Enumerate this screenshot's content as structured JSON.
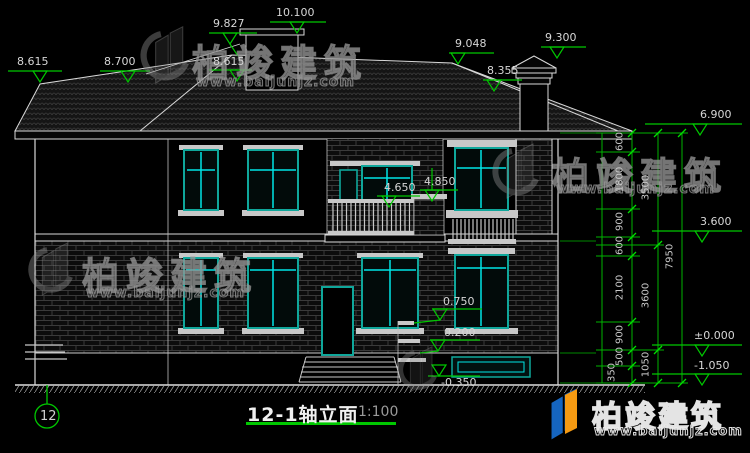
{
  "drawing": {
    "title": "12-1轴立面",
    "scale": "1:100",
    "axis_label": "12",
    "elevations": {
      "roof_left_edge": "8.615",
      "left_wing_eave": "8.700",
      "ridge_left": "9.827",
      "dormer_top": "10.100",
      "dormer_base": "8.615",
      "ridge_right": "9.048",
      "roof_right_lower": "8.355",
      "chimney_top": "9.300",
      "balcony_rail": "4.650",
      "parapet_cap": "4.850",
      "porch_upper": "0.750",
      "porch_mid": "0.200",
      "porch_lower": "-0.350",
      "right_eave": "6.900",
      "second_floor": "3.600",
      "ground_floor": "±0.000",
      "site_ground": "-1.050"
    },
    "dims": {
      "inner": [
        "600",
        "1800",
        "900",
        "600",
        "2100",
        "900",
        "500",
        "350"
      ],
      "middle": [
        "3500",
        "3600",
        "1050"
      ],
      "outer": "7950"
    }
  },
  "watermark": {
    "brand": "柏竣建筑",
    "url": "www.baijunjz.com"
  },
  "colors": {
    "dimension_green": "#00b400",
    "window_frame_teal": "#0fa79b",
    "mullion_cyan": "#00e6e6",
    "line_white": "#d9d9d9",
    "background": "#000000"
  }
}
